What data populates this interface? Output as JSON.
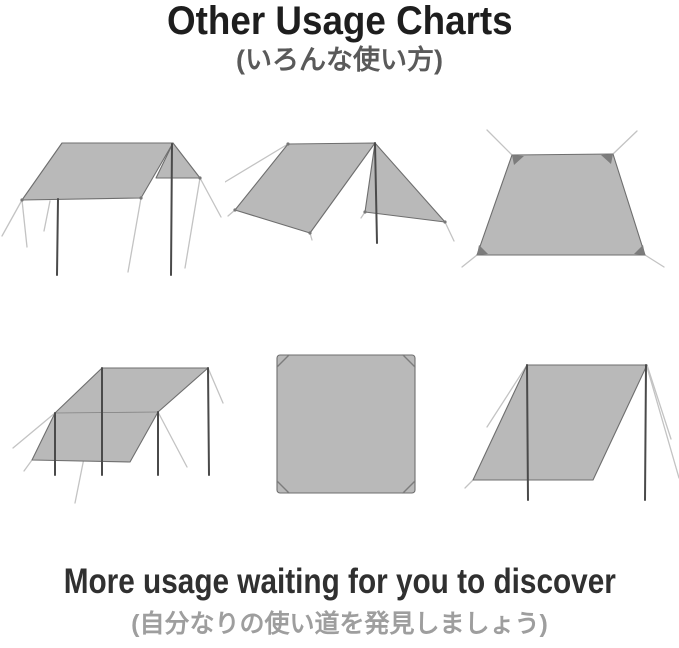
{
  "header": {
    "title": "Other Usage Charts",
    "subtitle_jp": "(いろんな使い方)"
  },
  "footer": {
    "title": "More usage waiting for you to discover",
    "subtitle_jp": "(自分なりの使い道を発見しましょう)"
  },
  "diagrams": [
    {
      "name": "tarp-flat-canopy-two-poles-diagram"
    },
    {
      "name": "tarp-a-frame-shelter-diagram"
    },
    {
      "name": "tarp-ground-sheet-diagram"
    },
    {
      "name": "tarp-slanted-awning-four-poles-diagram"
    },
    {
      "name": "tarp-flat-square-top-view-diagram"
    },
    {
      "name": "tarp-lean-to-windbreak-diagram"
    }
  ],
  "colors": {
    "tarp_fill": "#b9b9b9",
    "tarp_stroke": "#6e6e6e",
    "pole": "#4a4a4a",
    "guy_line": "#c3c3c3",
    "corner_mark": "#7c7c7c",
    "title_color": "#1e1e1e",
    "subtitle_color": "#5a5a5a",
    "footer_title_color": "#303030",
    "footer_subtitle_color": "#9e9e9e",
    "background": "#ffffff"
  }
}
